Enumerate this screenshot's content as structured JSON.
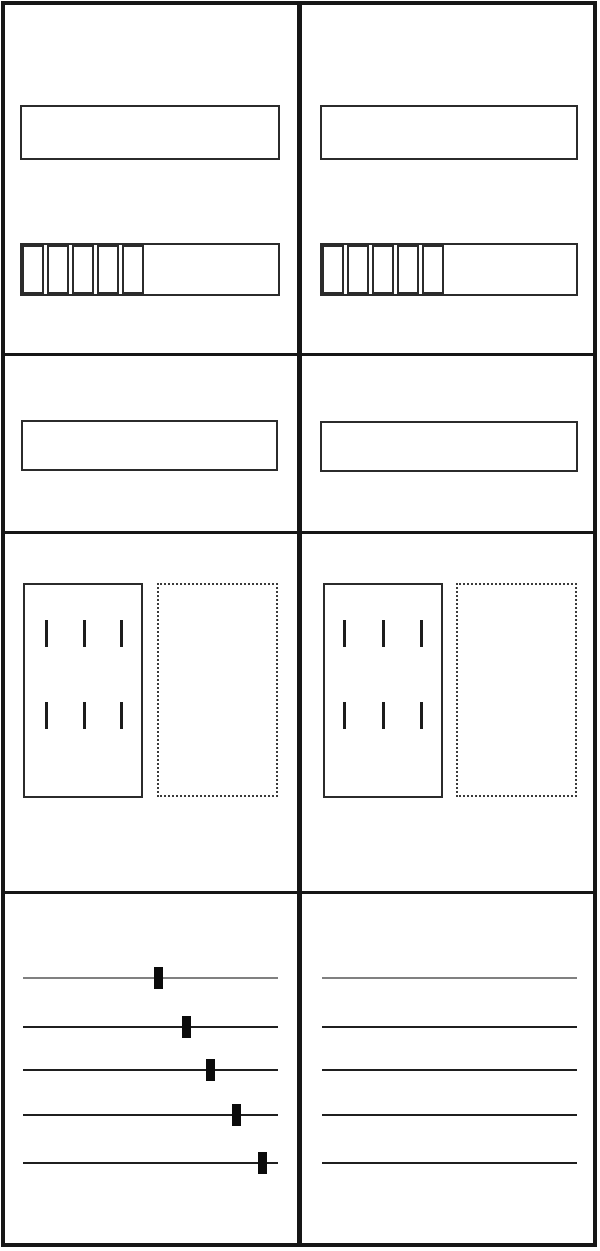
{
  "cabinet": {
    "kind": "two-field meter cabinet schematic",
    "colors": {
      "background": "#ffffff",
      "frame": "#161616",
      "panel_border": "#2b2b2b",
      "busbar_neutral_gray": "#808080",
      "busbar_phase_black": "#1f1f1f",
      "tap_black": "#0b0b0b"
    },
    "fields": [
      {
        "name": "field-left",
        "top_section": {
          "blank_panel": true,
          "terminal_strip": {
            "cell_count": 5
          }
        },
        "mid_section": {
          "blank_panel": true
        },
        "meter_section": {
          "tick_rows": 2,
          "tick_cols": 3,
          "tick_col_offsets": [
            20,
            58,
            95
          ],
          "tick_row_offsets": [
            35,
            117
          ],
          "dotted_reserve": true
        },
        "busbar_section": {
          "lines": [
            {
              "color": "#808080",
              "tap_center_x": 158
            },
            {
              "color": "#1f1f1f",
              "tap_center_x": 186
            },
            {
              "color": "#1f1f1f",
              "tap_center_x": 210
            },
            {
              "color": "#1f1f1f",
              "tap_center_x": 236
            },
            {
              "color": "#1f1f1f",
              "tap_center_x": 262
            }
          ],
          "line_tops": [
            977,
            1026,
            1069,
            1114,
            1162
          ]
        }
      },
      {
        "name": "field-right",
        "top_section": {
          "blank_panel": true,
          "terminal_strip": {
            "cell_count": 5
          }
        },
        "mid_section": {
          "blank_panel": true
        },
        "meter_section": {
          "tick_rows": 2,
          "tick_cols": 3,
          "tick_col_offsets": [
            18,
            57,
            95
          ],
          "tick_row_offsets": [
            35,
            117
          ],
          "dotted_reserve": true
        },
        "busbar_section": {
          "lines": [
            {
              "color": "#808080",
              "tap_center_x": null
            },
            {
              "color": "#1f1f1f",
              "tap_center_x": null
            },
            {
              "color": "#1f1f1f",
              "tap_center_x": null
            },
            {
              "color": "#1f1f1f",
              "tap_center_x": null
            },
            {
              "color": "#1f1f1f",
              "tap_center_x": null
            }
          ],
          "line_tops": [
            977,
            1026,
            1069,
            1114,
            1162
          ]
        }
      }
    ]
  }
}
